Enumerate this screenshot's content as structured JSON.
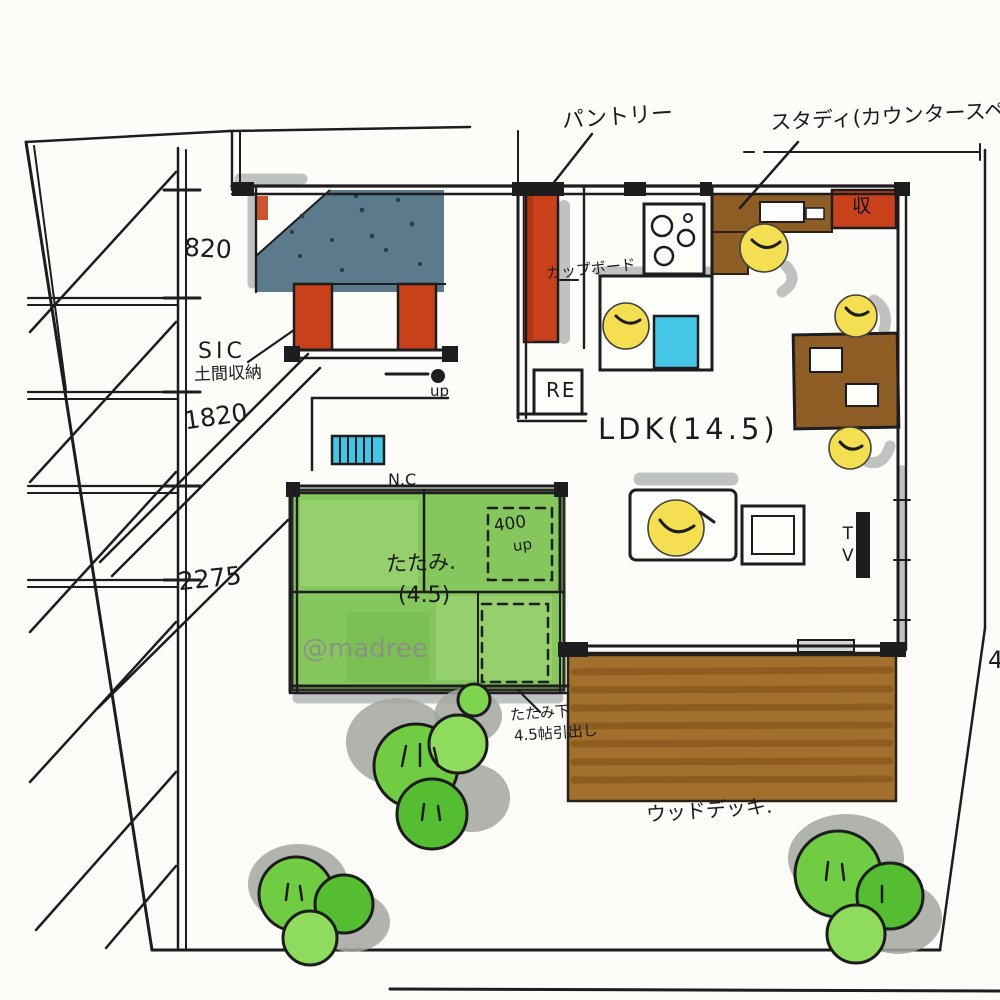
{
  "title": "hand-drawn floor plan sketch",
  "watermark": "@madree",
  "labels": {
    "pantry": "パントリー",
    "study": "スタディ(カウンタースペース).",
    "dim_820": "820",
    "dim_1820": "1820",
    "dim_2275": "2275",
    "sic_line1": "SIC",
    "sic_line2": "土間収納",
    "cupboard": "カップボード",
    "fridge": "RE",
    "ldk": "LDK(14.5)",
    "wall_note": "N.C",
    "step_400": "400",
    "step_up": "up",
    "entry_up": "up",
    "tatami_line1": "たたみ.",
    "tatami_line2": "(4.5)",
    "under_tatami_line1": "たたみ下",
    "under_tatami_line2": "4.5帖引出し",
    "wood_deck": "ウッドデッキ.",
    "tv": "TV",
    "storage_cabinet": "収",
    "edge_cutoff": "4"
  },
  "colors": {
    "ink": "#1d1d20",
    "entry_blue": "#5b7b8c",
    "closet_red": "#c8411b",
    "tatami_green": "#85c75c",
    "tree_green": "#70cc42",
    "deck_brown": "#a2702c",
    "furniture_brown": "#8e5d26",
    "chair_yellow": "#f4df52",
    "sink_cyan": "#45c6e6",
    "marker_gray": "#9aa09b"
  }
}
